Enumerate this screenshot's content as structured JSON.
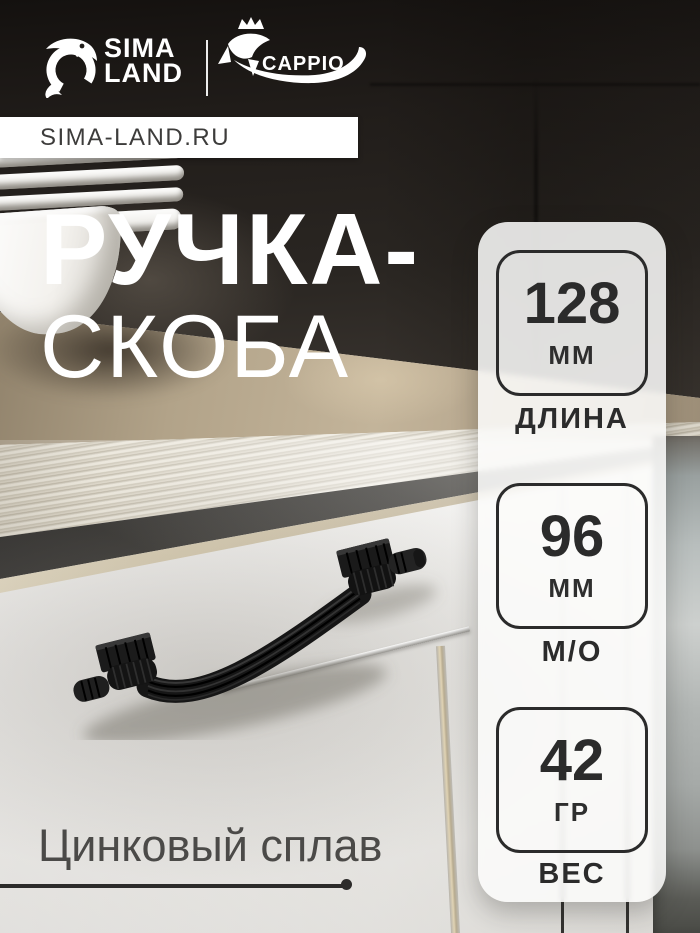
{
  "brand": {
    "sima": {
      "line1": "SIMA",
      "line2": "LAND"
    },
    "cappio": {
      "name": "CAPPIO"
    },
    "website": "SIMA-LAND.RU"
  },
  "title": {
    "line1": "РУЧКА-",
    "line2": "СКОБА"
  },
  "specs": [
    {
      "value": "128",
      "unit": "ММ",
      "label": "ДЛИНА"
    },
    {
      "value": "96",
      "unit": "ММ",
      "label": "М/О"
    },
    {
      "value": "42",
      "unit": "ГР",
      "label": "ВЕС"
    }
  ],
  "material": {
    "label": "Цинковый сплав"
  },
  "photo": {
    "subject": "чёрная ручка-скоба на белом кухонном фасаде"
  },
  "colors": {
    "accent_dark": "#2b2b2b",
    "title_text": "#ffffff",
    "wood": "#b5a78e",
    "gold_trim": "#d6c9ab",
    "dark_wall": "#2a2622",
    "handle": "#161616"
  }
}
